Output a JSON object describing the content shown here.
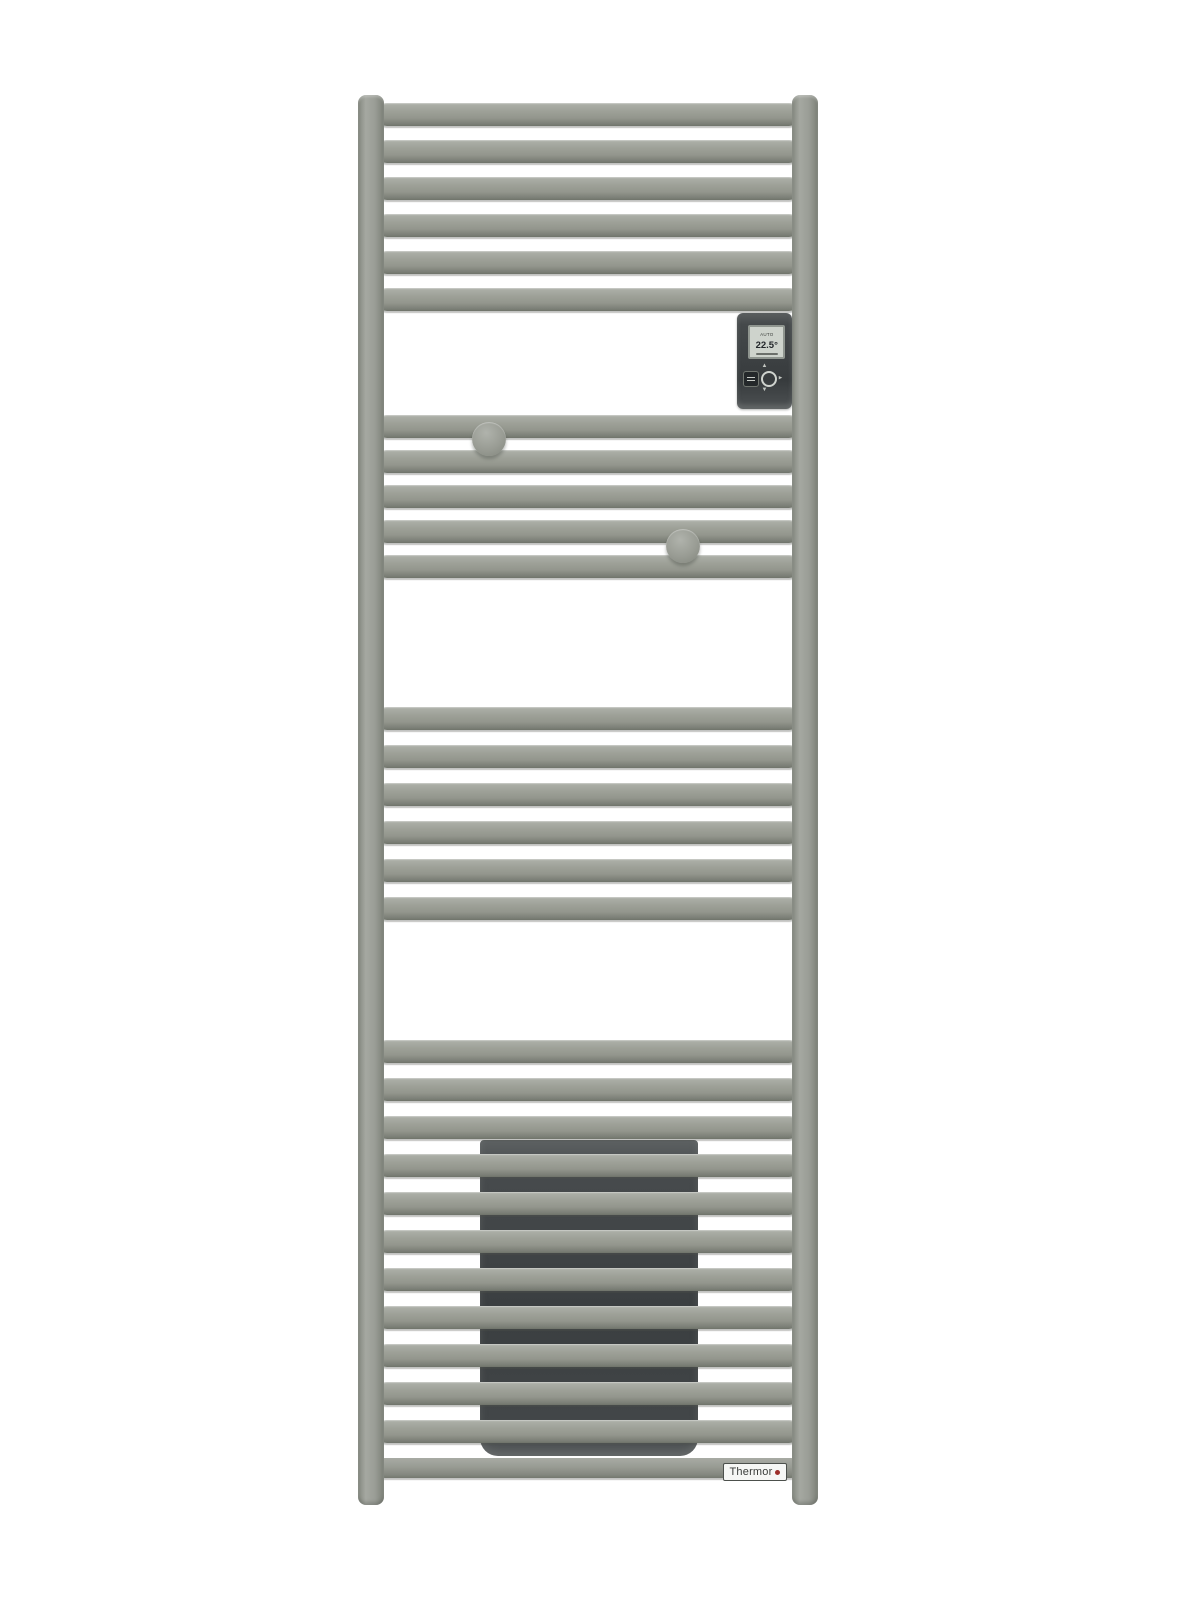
{
  "brand": {
    "name": "Thermor"
  },
  "controller": {
    "mode": "AUTO",
    "temperature": "22.5°",
    "icons": {
      "up": "▲",
      "down": "▼",
      "right": "▸"
    }
  },
  "badge": {
    "dot_icon": "brand-red-dot"
  },
  "colors": {
    "radiator_grey": "#9a9d96",
    "heating_panel_dark": "#3d4143",
    "controller_dark": "#3c4042",
    "screen_bg": "#ced3cc",
    "badge_bg": "#f6f7f5",
    "brand_dot_red": "#9d2f2a",
    "background": "#ffffff"
  },
  "radiator": {
    "posts": [
      {
        "x": 358
      },
      {
        "x": 792
      }
    ],
    "post_top": 95,
    "post_height": 1410,
    "bar_groups": [
      {
        "name": "top-group",
        "y": 103,
        "count": 6,
        "pitch": 37
      },
      {
        "name": "upper-middle-group",
        "y": 415,
        "count": 5,
        "pitch": 35
      },
      {
        "name": "middle-group",
        "y": 707,
        "count": 6,
        "pitch": 38
      },
      {
        "name": "lower-group",
        "y": 1040,
        "count": 11,
        "pitch": 38
      }
    ],
    "hooks": [
      {
        "cx": 489,
        "cy": 439
      },
      {
        "cx": 683,
        "cy": 546
      }
    ],
    "heating_panel": {
      "x": 480,
      "y": 1140,
      "w": 218,
      "h": 316
    }
  }
}
